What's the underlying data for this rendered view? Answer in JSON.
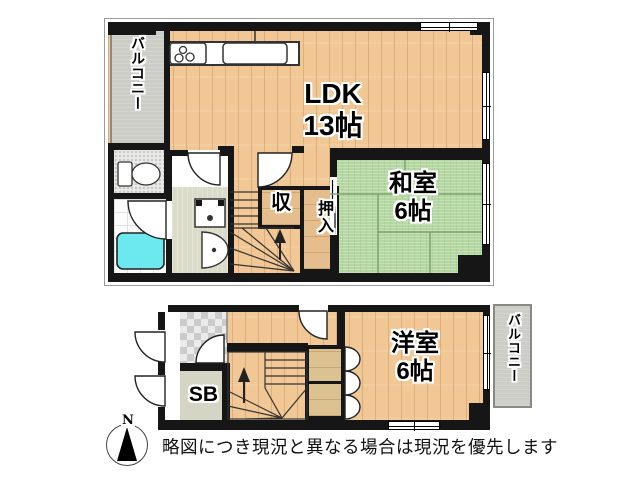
{
  "upper_floor": {
    "balcony_label": "バルコニー",
    "ldk": {
      "name": "LDK",
      "size": "13帖"
    },
    "washitsu": {
      "name": "和室",
      "size": "6帖"
    },
    "closet_label": "収",
    "oshiire_label": "押入"
  },
  "lower_floor": {
    "yoshitsu": {
      "name": "洋室",
      "size": "6帖"
    },
    "balcony_label": "バルコニー",
    "shoe_box_label": "SB"
  },
  "compass": {
    "north_label": "N"
  },
  "footer": {
    "disclaimer": "略図につき現況と異なる場合は現況を優先します"
  },
  "colors": {
    "wall": "#161616",
    "wood_floor": "#f0c795",
    "tatami": "#b5d8a2",
    "balcony": "#cdcdc8",
    "bathtub": "#6ce9ee",
    "entrance_tile": "#cbcbcb",
    "washroom_floor": "#dbdbc9",
    "closet_wood": "#dcc191"
  }
}
